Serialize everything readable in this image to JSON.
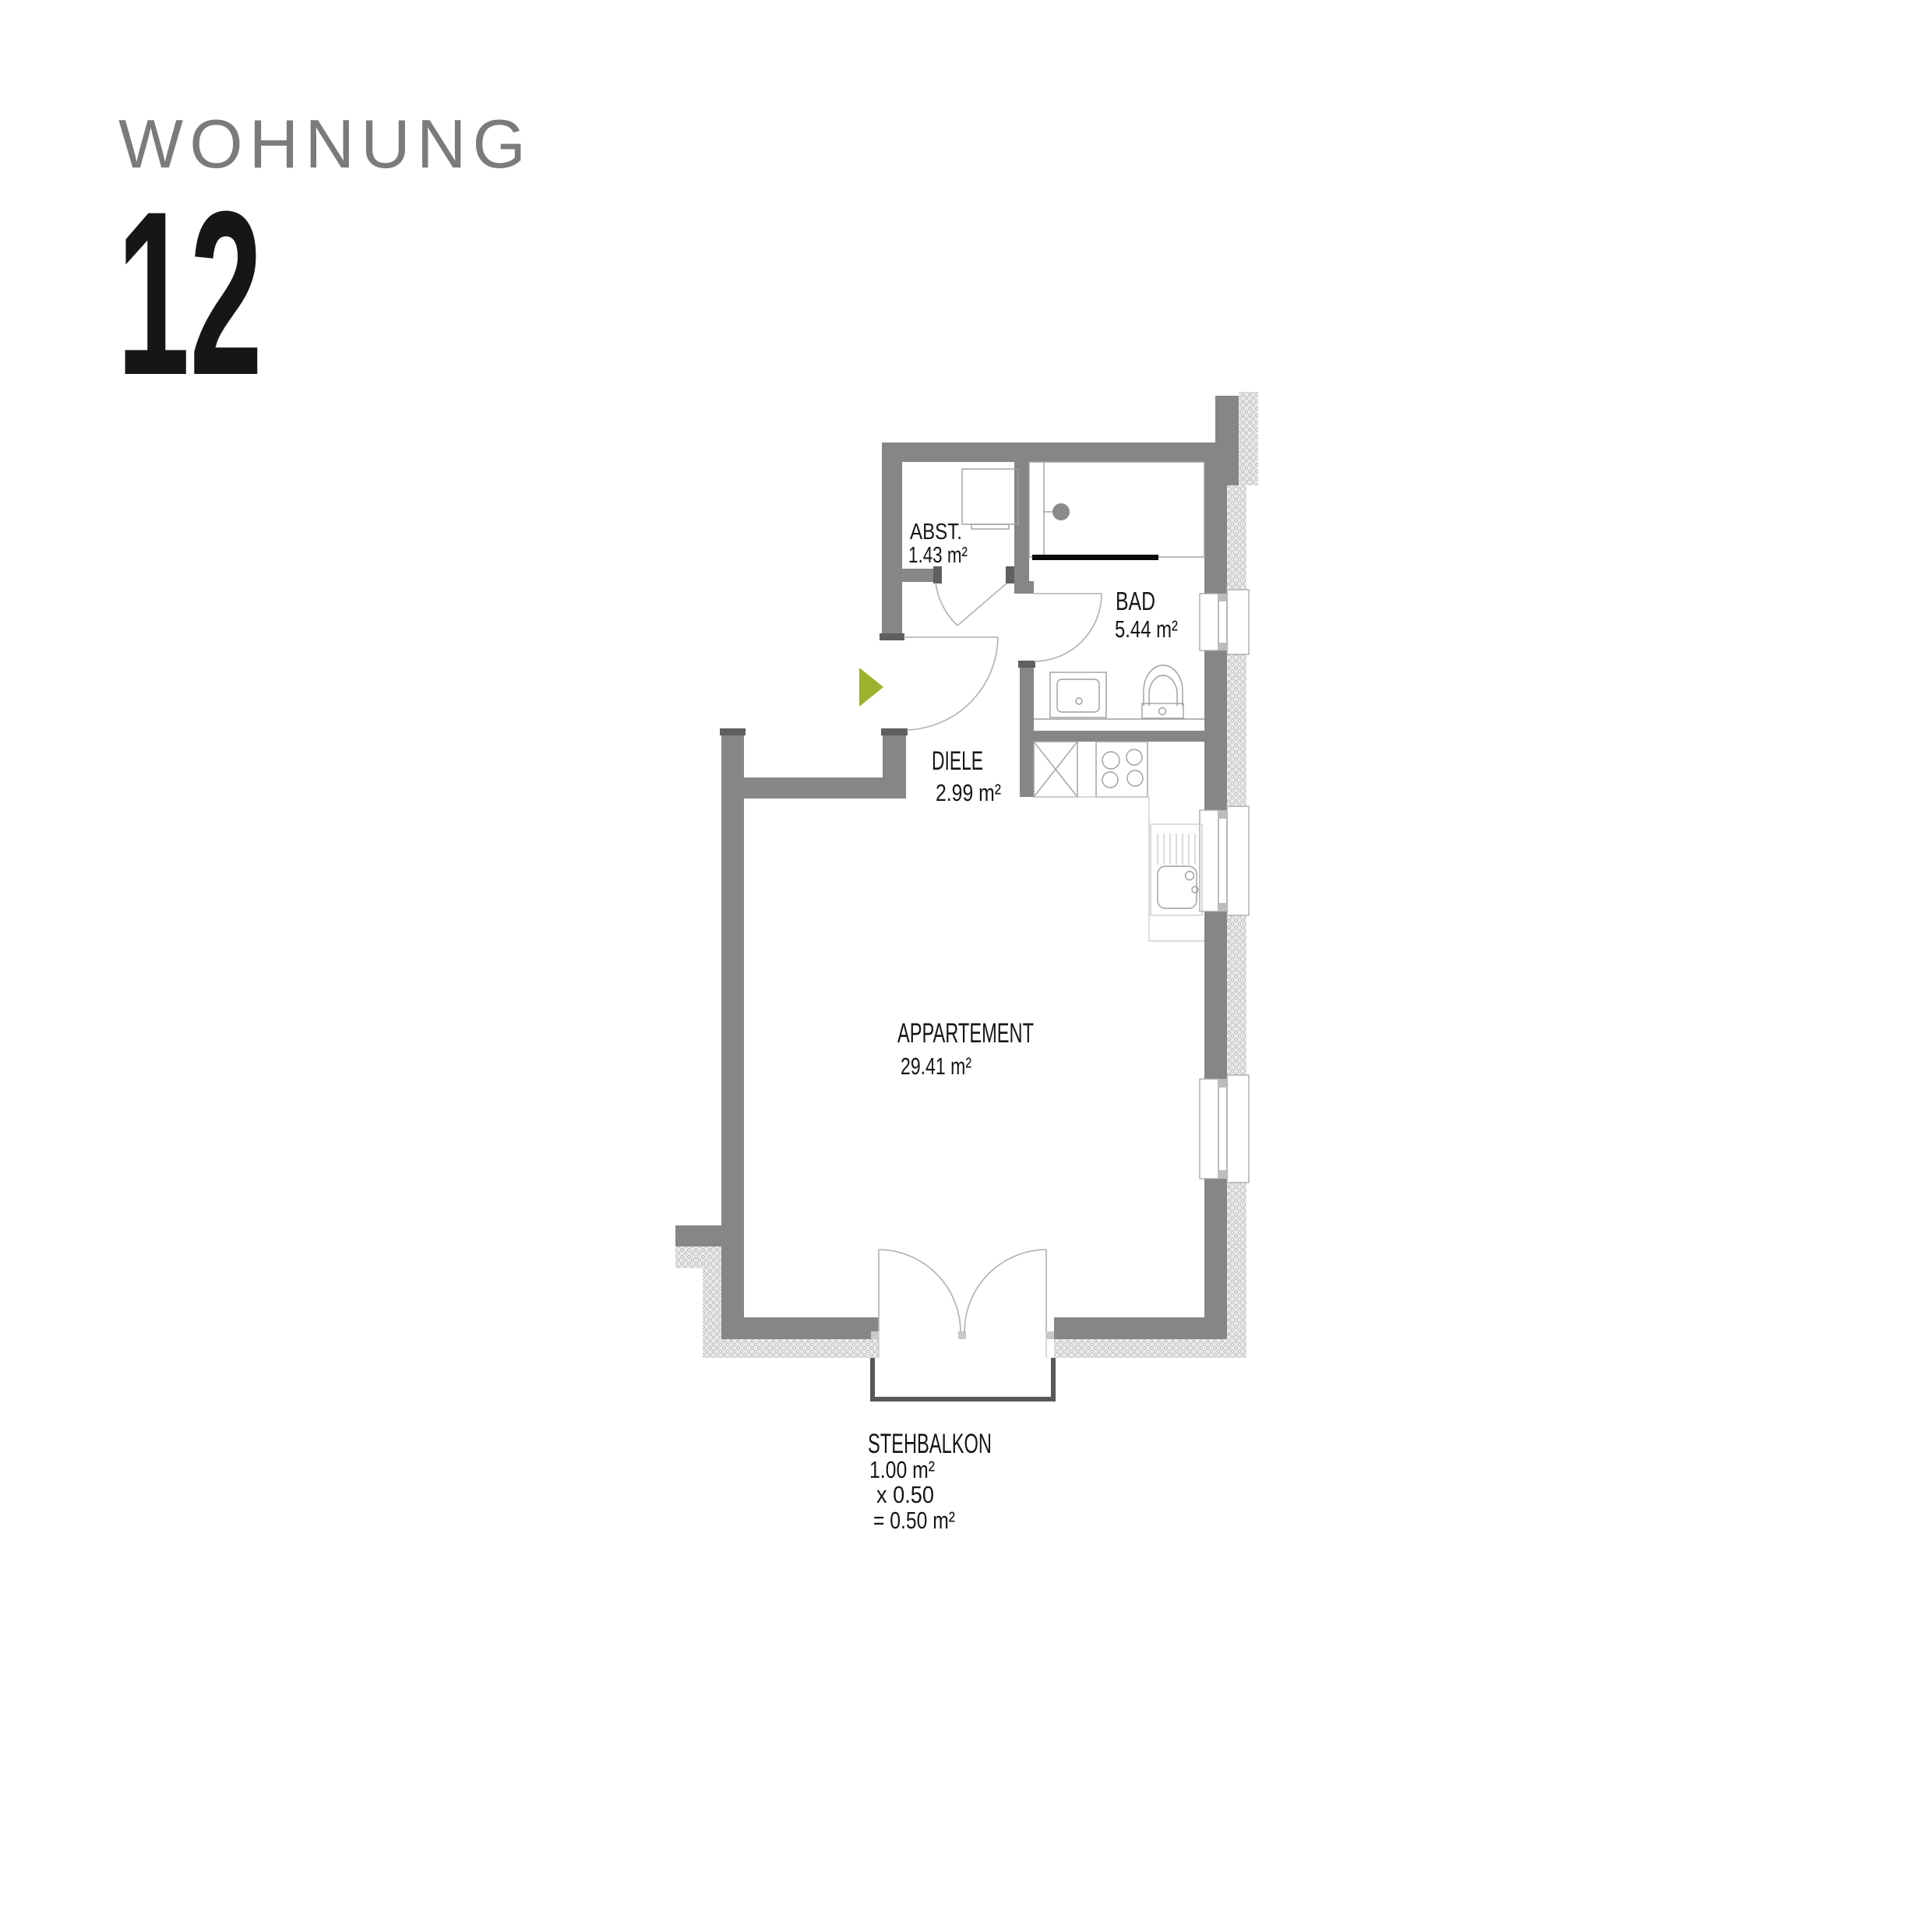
{
  "header": {
    "title": "WOHNUNG",
    "unit_number": "12"
  },
  "plan": {
    "rooms": {
      "abst": {
        "name": "ABST.",
        "area": "1.43 m²"
      },
      "bad": {
        "name": "BAD",
        "area": "5.44 m²"
      },
      "diele": {
        "name": "DIELE",
        "area": "2.99 m²"
      },
      "appartement": {
        "name": "APPARTEMENT",
        "area": "29.41 m²"
      },
      "stehbalkon": {
        "name": "STEHBALKON",
        "area": "1.00 m²",
        "factor": "x  0.50",
        "result": "= 0.50 m²"
      }
    },
    "colors": {
      "accent_green": "#9ab22e",
      "wall": "#868686",
      "wall_cap": "#5f5f5f",
      "hatch_dot": "#b3b3b3",
      "title_gray": "#7b7b7b",
      "door_post": "#c9c9c9",
      "balcony_line": "#585858"
    },
    "icons": {
      "entrance_arrow": "entrance direction arrow"
    }
  }
}
